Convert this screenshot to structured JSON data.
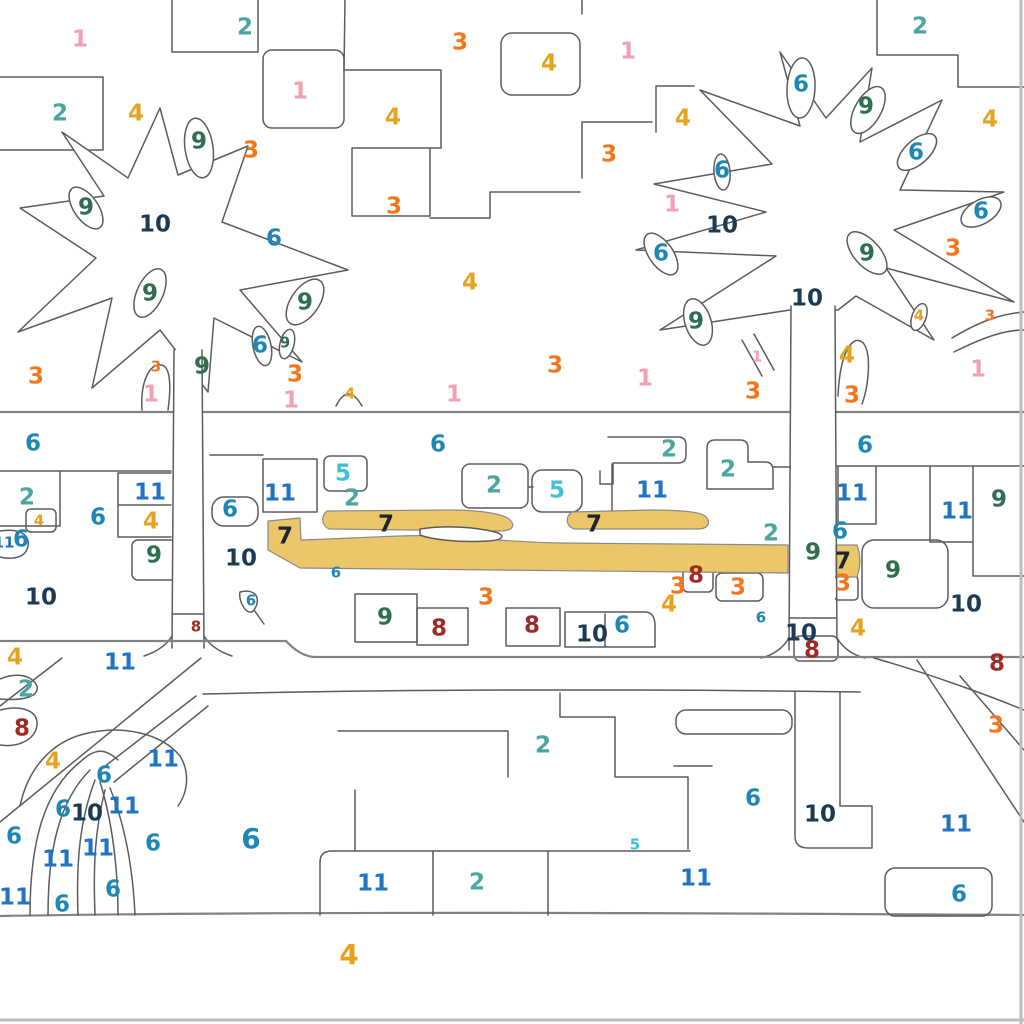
{
  "app": {
    "kind": "paint-by-number-canvas",
    "background": "#ffffff",
    "outline_color": "#5c5c5c",
    "canvas_edge_color": "#bdbdbd"
  },
  "fill_state": {
    "filled_number": "7",
    "filled_color": "#ecc76a"
  },
  "palette": {
    "1": "#f4a0b4",
    "2": "#4aa69e",
    "3": "#f1771d",
    "4": "#e5a320",
    "5": "#3fc0d8",
    "6": "#1e87b4",
    "7": "#1d2531",
    "8": "#9e2b24",
    "9": "#2f6e4e",
    "10": "#1b3b54",
    "11": "#2173c4"
  },
  "label_sizes": {
    "sm": 15,
    "lg": 23,
    "xl": 28
  },
  "labels": [
    [
      "1",
      80,
      38,
      "lg"
    ],
    [
      "2",
      245,
      26,
      "lg"
    ],
    [
      "1",
      300,
      90,
      "lg"
    ],
    [
      "2",
      60,
      112,
      "lg"
    ],
    [
      "4",
      136,
      112,
      "lg"
    ],
    [
      "9",
      199,
      140,
      "lg"
    ],
    [
      "3",
      251,
      149,
      "lg"
    ],
    [
      "3",
      460,
      41,
      "lg"
    ],
    [
      "4",
      549,
      62,
      "lg"
    ],
    [
      "1",
      628,
      50,
      "lg"
    ],
    [
      "4",
      393,
      116,
      "lg"
    ],
    [
      "3",
      394,
      205,
      "lg"
    ],
    [
      "3",
      609,
      153,
      "lg"
    ],
    [
      "4",
      683,
      117,
      "lg"
    ],
    [
      "1",
      672,
      203,
      "lg"
    ],
    [
      "6",
      661,
      252,
      "lg"
    ],
    [
      "6",
      722,
      169,
      "lg"
    ],
    [
      "2",
      920,
      25,
      "lg"
    ],
    [
      "6",
      801,
      83,
      "lg"
    ],
    [
      "9",
      866,
      105,
      "lg"
    ],
    [
      "6",
      916,
      151,
      "lg"
    ],
    [
      "4",
      990,
      118,
      "lg"
    ],
    [
      "6",
      981,
      210,
      "lg"
    ],
    [
      "10",
      722,
      224,
      "lg"
    ],
    [
      "9",
      867,
      252,
      "lg"
    ],
    [
      "3",
      953,
      247,
      "lg"
    ],
    [
      "10",
      807,
      297,
      "lg"
    ],
    [
      "9",
      696,
      320,
      "lg"
    ],
    [
      "4",
      919,
      315,
      "sm"
    ],
    [
      "3",
      990,
      315,
      "sm"
    ],
    [
      "9",
      86,
      206,
      "lg"
    ],
    [
      "10",
      155,
      223,
      "lg"
    ],
    [
      "6",
      274,
      237,
      "lg"
    ],
    [
      "9",
      150,
      292,
      "lg"
    ],
    [
      "9",
      305,
      301,
      "lg"
    ],
    [
      "4",
      470,
      281,
      "lg"
    ],
    [
      "3",
      36,
      375,
      "lg"
    ],
    [
      "3",
      156,
      366,
      "sm"
    ],
    [
      "9",
      202,
      365,
      "lg"
    ],
    [
      "6",
      260,
      344,
      "lg"
    ],
    [
      "9",
      285,
      342,
      "sm"
    ],
    [
      "3",
      295,
      373,
      "lg"
    ],
    [
      "1",
      151,
      393,
      "lg"
    ],
    [
      "1",
      291,
      399,
      "lg"
    ],
    [
      "4",
      350,
      393,
      "sm"
    ],
    [
      "1",
      454,
      393,
      "lg"
    ],
    [
      "3",
      555,
      364,
      "lg"
    ],
    [
      "1",
      645,
      377,
      "lg"
    ],
    [
      "1",
      757,
      356,
      "sm"
    ],
    [
      "4",
      847,
      354,
      "lg"
    ],
    [
      "3",
      753,
      390,
      "lg"
    ],
    [
      "3",
      852,
      394,
      "lg"
    ],
    [
      "1",
      978,
      368,
      "lg"
    ],
    [
      "6",
      33,
      442,
      "lg"
    ],
    [
      "6",
      438,
      443,
      "lg"
    ],
    [
      "2",
      669,
      448,
      "lg"
    ],
    [
      "6",
      865,
      444,
      "lg"
    ],
    [
      "2",
      27,
      496,
      "lg"
    ],
    [
      "11",
      150,
      491,
      "lg"
    ],
    [
      "6",
      98,
      516,
      "lg"
    ],
    [
      "4",
      39,
      520,
      "sm"
    ],
    [
      "4",
      151,
      520,
      "lg"
    ],
    [
      "11",
      4,
      542,
      "sm"
    ],
    [
      "6",
      21,
      538,
      "lg"
    ],
    [
      "9",
      154,
      554,
      "lg"
    ],
    [
      "10",
      41,
      596,
      "lg"
    ],
    [
      "8",
      196,
      626,
      "sm"
    ],
    [
      "5",
      343,
      472,
      "lg"
    ],
    [
      "11",
      280,
      492,
      "lg"
    ],
    [
      "2",
      352,
      497,
      "lg"
    ],
    [
      "6",
      230,
      508,
      "lg"
    ],
    [
      "7",
      285,
      535,
      "lg"
    ],
    [
      "10",
      241,
      557,
      "lg"
    ],
    [
      "6",
      336,
      572,
      "sm"
    ],
    [
      "6",
      251,
      600,
      "sm"
    ],
    [
      "9",
      385,
      616,
      "lg"
    ],
    [
      "8",
      439,
      627,
      "lg"
    ],
    [
      "2",
      494,
      484,
      "lg"
    ],
    [
      "5",
      557,
      489,
      "lg"
    ],
    [
      "7",
      386,
      523,
      "lg"
    ],
    [
      "7",
      594,
      523,
      "lg"
    ],
    [
      "11",
      652,
      489,
      "lg"
    ],
    [
      "3",
      486,
      596,
      "lg"
    ],
    [
      "8",
      532,
      624,
      "lg"
    ],
    [
      "10",
      592,
      633,
      "lg"
    ],
    [
      "6",
      622,
      624,
      "lg"
    ],
    [
      "2",
      728,
      468,
      "lg"
    ],
    [
      "2",
      771,
      532,
      "lg"
    ],
    [
      "6",
      840,
      530,
      "lg"
    ],
    [
      "9",
      813,
      551,
      "lg"
    ],
    [
      "7",
      843,
      560,
      "lg"
    ],
    [
      "3",
      843,
      582,
      "lg"
    ],
    [
      "9",
      893,
      569,
      "lg"
    ],
    [
      "11",
      852,
      492,
      "lg"
    ],
    [
      "11",
      957,
      510,
      "lg"
    ],
    [
      "9",
      999,
      498,
      "lg"
    ],
    [
      "10",
      966,
      603,
      "lg"
    ],
    [
      "4",
      858,
      627,
      "lg"
    ],
    [
      "8",
      696,
      574,
      "lg"
    ],
    [
      "3",
      678,
      585,
      "lg"
    ],
    [
      "3",
      738,
      586,
      "lg"
    ],
    [
      "4",
      669,
      603,
      "lg"
    ],
    [
      "6",
      761,
      617,
      "sm"
    ],
    [
      "10",
      801,
      632,
      "lg"
    ],
    [
      "8",
      812,
      649,
      "lg"
    ],
    [
      "11",
      120,
      661,
      "lg"
    ],
    [
      "4",
      15,
      656,
      "lg"
    ],
    [
      "2",
      26,
      688,
      "lg"
    ],
    [
      "8",
      22,
      727,
      "lg"
    ],
    [
      "4",
      53,
      760,
      "lg"
    ],
    [
      "11",
      163,
      758,
      "lg"
    ],
    [
      "6",
      104,
      774,
      "lg"
    ],
    [
      "6",
      63,
      808,
      "lg"
    ],
    [
      "10",
      87,
      812,
      "lg"
    ],
    [
      "11",
      124,
      805,
      "lg"
    ],
    [
      "6",
      14,
      835,
      "lg"
    ],
    [
      "11",
      98,
      847,
      "lg"
    ],
    [
      "6",
      153,
      842,
      "lg"
    ],
    [
      "6",
      251,
      838,
      "xl"
    ],
    [
      "11",
      58,
      858,
      "lg"
    ],
    [
      "11",
      15,
      896,
      "lg"
    ],
    [
      "6",
      113,
      888,
      "lg"
    ],
    [
      "6",
      62,
      903,
      "lg"
    ],
    [
      "2",
      543,
      744,
      "lg"
    ],
    [
      "5",
      635,
      844,
      "sm"
    ],
    [
      "11",
      373,
      882,
      "lg"
    ],
    [
      "2",
      477,
      881,
      "lg"
    ],
    [
      "4",
      349,
      954,
      "xl"
    ],
    [
      "8",
      997,
      662,
      "lg"
    ],
    [
      "3",
      996,
      724,
      "lg"
    ],
    [
      "6",
      753,
      797,
      "lg"
    ],
    [
      "10",
      820,
      813,
      "lg"
    ],
    [
      "11",
      956,
      823,
      "lg"
    ],
    [
      "11",
      696,
      877,
      "lg"
    ],
    [
      "6",
      959,
      893,
      "lg"
    ]
  ]
}
